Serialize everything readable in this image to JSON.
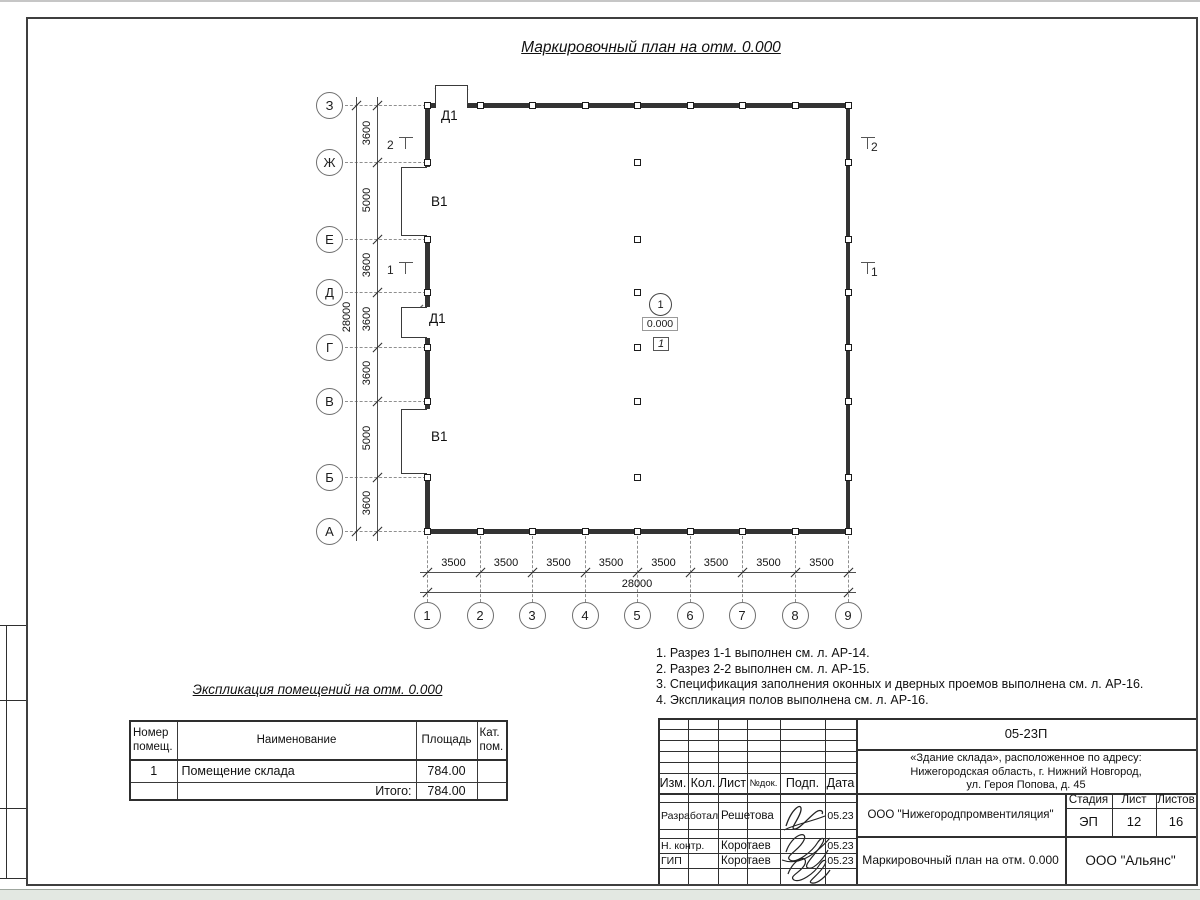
{
  "sheet": {
    "title": "Маркировочный план на отм. 0.000"
  },
  "plan": {
    "vertical_axes": [
      "З",
      "Ж",
      "Е",
      "Д",
      "Г",
      "В",
      "Б",
      "А"
    ],
    "vertical_dims": [
      "3600",
      "5000",
      "3600",
      "3600",
      "3600",
      "5000",
      "3600"
    ],
    "vertical_total": "28000",
    "horizontal_axes": [
      "1",
      "2",
      "3",
      "4",
      "5",
      "6",
      "7",
      "8",
      "9"
    ],
    "horizontal_dims": [
      "3500",
      "3500",
      "3500",
      "3500",
      "3500",
      "3500",
      "3500",
      "3500"
    ],
    "horizontal_total": "28000",
    "top_door_label": "Д1",
    "left_door_label": "Д1",
    "gate_labels": [
      "В1",
      "В1"
    ],
    "section_marks_left": [
      "2",
      "1"
    ],
    "section_marks_right": [
      "2",
      "1"
    ],
    "room_marker": {
      "number": "1",
      "elevation": "0.000",
      "floor_type": "1"
    }
  },
  "notes": [
    "1. Разрез 1-1 выполнен см. л. АР-14.",
    "2. Разрез 2-2 выполнен см. л. АР-15.",
    "3. Спецификация заполнения оконных и дверных проемов выполнена см. л. АР-16.",
    "4. Экспликация полов выполнена см. л. АР-16."
  ],
  "schedule": {
    "title": "Экспликация помещений на отм. 0.000",
    "headers": [
      "Номер помещ.",
      "Наименование",
      "Площадь",
      "Кат. пом."
    ],
    "rows": [
      {
        "num": "1",
        "name": "Помещение склада",
        "area": "784.00",
        "cat": ""
      }
    ],
    "total_label": "Итого:",
    "total_area": "784.00"
  },
  "titleblock": {
    "doc_number": "05-23П",
    "project_lines": [
      "«Здание склада», расположенное по адресу:",
      "Нижегородская область, г. Нижний Новгород,",
      "ул. Героя Попова, д. 45"
    ],
    "design_org": "ООО \"Нижегородпромвентиляция\"",
    "sheet_name": "Маркировочный план на отм. 0.000",
    "client_org": "ООО \"Альянс\"",
    "stage_label": "Стадия",
    "stage_value": "ЭП",
    "sheet_label": "Лист",
    "sheet_value": "12",
    "sheets_label": "Листов",
    "sheets_value": "16",
    "rev_headers": [
      "Изм.",
      "Кол.",
      "Лист",
      "№док.",
      "Подп.",
      "Дата"
    ],
    "sign_rows": [
      {
        "role": "Разработал",
        "name": "Решетова",
        "date": "05.23"
      },
      {
        "role": "Н. контр.",
        "name": "Коротаев",
        "date": "05.23"
      },
      {
        "role": "ГИП",
        "name": "Коротаев",
        "date": "05.23"
      }
    ]
  }
}
